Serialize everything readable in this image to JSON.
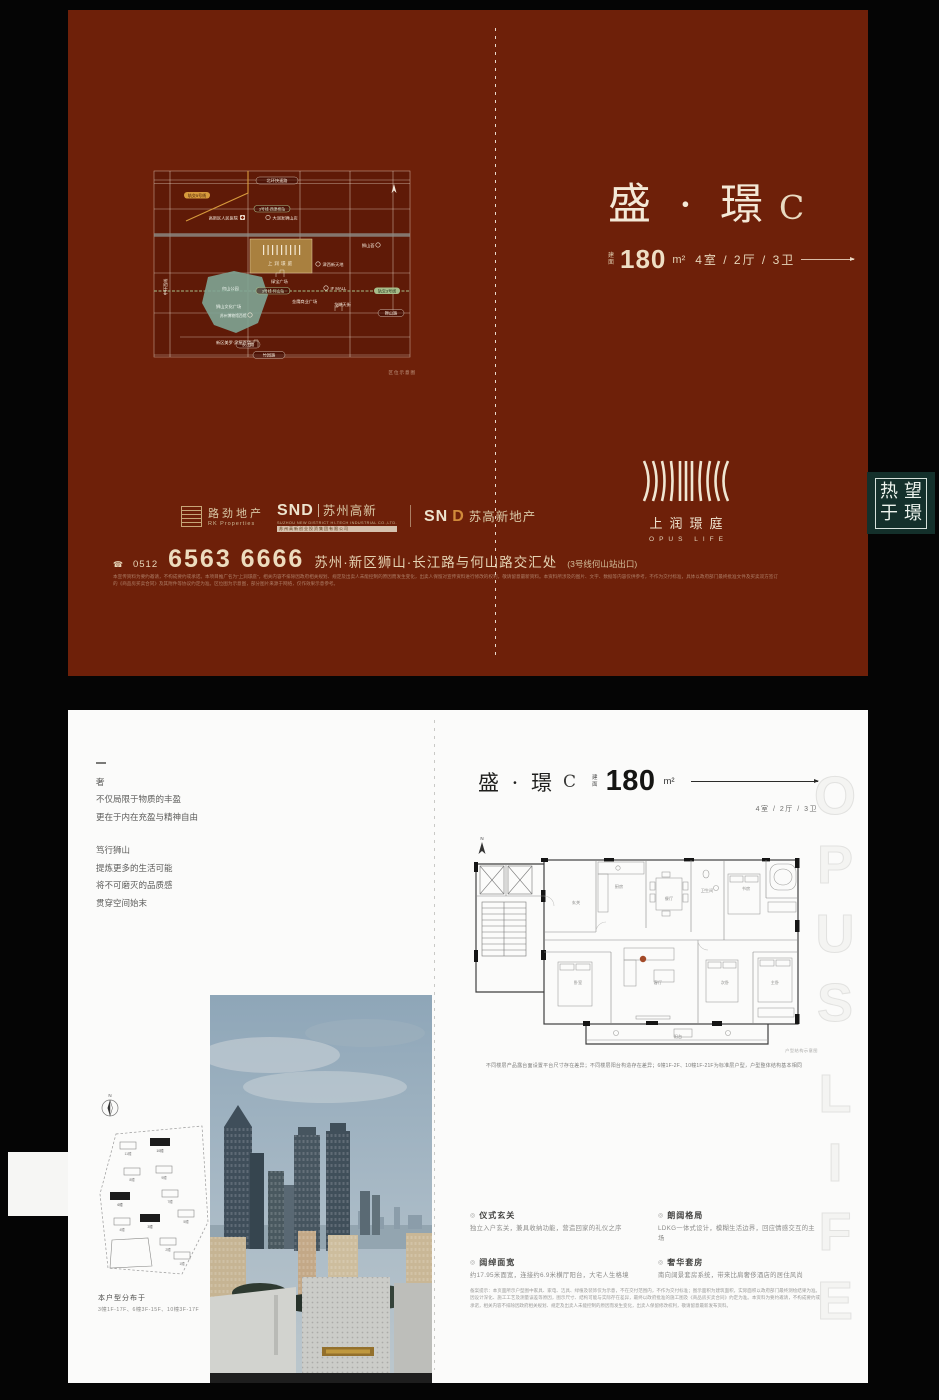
{
  "cover": {
    "title_main": "盛 · 璟",
    "title_suffix": "C",
    "area_prefix_1": "建",
    "area_prefix_2": "面",
    "area_value": "180",
    "area_unit": "m²",
    "rooms": "4室 / 2厅 / 3卫",
    "logo_cn": "上润璟庭",
    "logo_en": "OPUS LIFE",
    "brand_rk_cn": "路劲地产",
    "brand_rk_en": "RK Properties",
    "brand_snd_1": "SND",
    "brand_snd_1_cn": "苏州高新",
    "brand_snd_1_en": "SUZHOU NEW DISTRICT HI-TECH INDUSTRIAL CO.,LTD.",
    "brand_snd_1_strip": "苏州高新创业投资集团有限公司",
    "brand_snd_2": "SN",
    "brand_snd_2_d": "D",
    "brand_snd_2_cn": "苏高新地产",
    "phone_icon": "☎",
    "phone_code": "0512",
    "phone": "6563 6666",
    "address": "苏州·新区狮山·长江路与何山路交汇处",
    "address_note": "(3号线何山站出口)",
    "disclaimer": "本宣传资料为要约邀请，不构成要约或承诺。本项目推广名为“上润璟庭”，相关内容不排除因政府相关规划、规定及出卖人未能控制的原因而发生变化，出卖人保留对宣传资料进行修改的权利，敬请留意最新资料。本资料所涉及的图片、文字、数据等内容仅供参考，不作为交付标准，具体以政府部门最终批准文件及买卖双方签订的《商品房买卖合同》及其附件等协议约定为准。区位图为示意图，部分图片来源于网络，仅作效果示意参考。",
    "seal_tl": "热",
    "seal_tr": "望",
    "seal_bl": "于",
    "seal_br": "璟",
    "map": {
      "caption": "区位示意图",
      "road_top": "北环快速路",
      "road_left": "中环西线",
      "road_bottom": "竹园路",
      "road_shishan": "狮山路",
      "road_changjiang": "长江路",
      "metro_orange": "轨交5号线",
      "metro_green": "轨交3号线",
      "station_1": "3号线·西津桥站",
      "station_2": "3号线·何山站",
      "poi_hospital": "高新区人民医院",
      "poi_rt": "大润发狮山店",
      "poi_jinxi": "津西新天地",
      "poi_shishanhui": "狮山荟",
      "poi_lvbao": "绿宝广场",
      "poi_ifmall": "IF MALL",
      "poi_wenhua": "狮山文化广场",
      "poi_museum": "苏州博物馆西馆",
      "poi_jinying": "金鹰商业广场",
      "poi_longhu": "龙湖天街",
      "poi_park": "何山公园",
      "poi_meiluo": "新区美罗·泉屋百货",
      "project": "上润璟庭"
    }
  },
  "inner": {
    "intro_mark": "",
    "intro_l1": "奢",
    "intro_l2": "不仅局限于物质的丰盈",
    "intro_l3": "更在于内在充盈与精神自由",
    "intro_l4": "笃行狮山",
    "intro_l5": "提炼更多的生活可能",
    "intro_l6": "将不可磨灭的品质感",
    "intro_l7": "贯穿空间始末",
    "header_title": "盛 · 璟",
    "header_suffix": "C",
    "header_area_prefix_1": "建",
    "header_area_prefix_2": "面",
    "header_area": "180",
    "header_unit": "m²",
    "header_rooms": "4室 / 2厅 / 3卫",
    "plan_north": "N",
    "plan_note": "户型结构示意图",
    "plan_disclaimer": "不同楼层产品露台面设置平台尺寸存在差异；不同楼层阳台构造存在差异；6幢1F-2F、10幢1F-21F为标准层户型，户型整体结构基本相同",
    "rooms": {
      "r1": "玄关",
      "r2": "餐厅",
      "r3": "厨房",
      "r4": "客厅",
      "r5": "阳台",
      "r6": "主卧",
      "r7": "次卧",
      "r8": "书房",
      "r9": "卧室",
      "r10": "卫生间"
    },
    "siteplan": {
      "north": "N",
      "caption": "本户型分布于",
      "detail": "3幢1F-17F、6幢3F-15F、10幢3F-17F",
      "b1": "1幢",
      "b2": "2幢",
      "b3": "3幢",
      "b4": "4幢",
      "b5": "5幢",
      "b6": "6幢",
      "b7": "7幢",
      "b8": "8幢",
      "b9": "9幢",
      "b10": "10幢",
      "b11": "11幢"
    },
    "features": {
      "f1_title": "仪式玄关",
      "f1_desc": "独立入户玄关，兼具收纳功能，营造回家的礼仪之序",
      "f2_title": "阔绰面宽",
      "f2_desc": "约17.95米面宽，连接约6.9米横厅阳台，大宅人生格境",
      "f3_title": "朗阔格局",
      "f3_desc": "LDKG一体式设计，模糊生活边界，回应情感交互的主场",
      "f4_title": "奢华套房",
      "f4_desc": "南向阔景套房系统，带来比肩奢侈酒店的居住风尚"
    },
    "legal": "备案提示：本页面所示户型图中家具、家电、洁具、绿植及装饰仅为示意，不在交付范围内，不作为交付标准；图示面积为建筑面积，实际面积以政府部门最终测绘结果为准。因设计深化、施工工艺及测量误差等原因，图示尺寸、结构可能与实际存在差异，最终以政府批准的施工图及《商品房买卖合同》约定为准。本资料为要约邀请，不构成要约或承诺，相关内容不排除因政府相关规划、规定及出卖人未能控制的原因而发生变化，出卖人保留修改权利，敬请留意最新发布资料。",
    "watermark_1": "OPUS",
    "watermark_2": "LIFE"
  }
}
